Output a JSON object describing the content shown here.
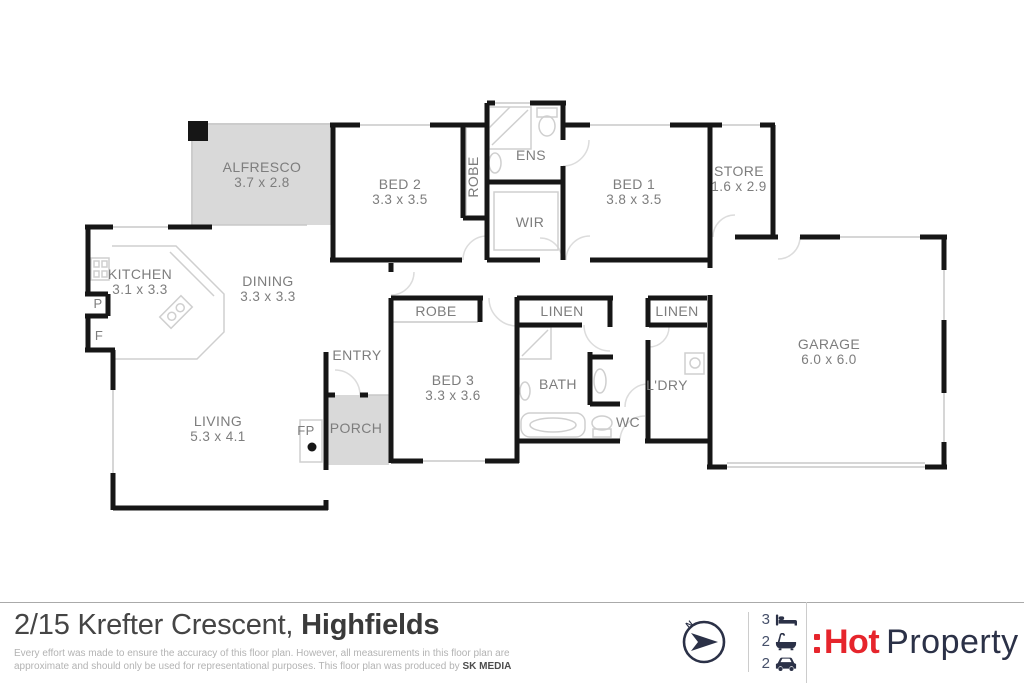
{
  "plan": {
    "rooms": {
      "alfresco": {
        "name": "ALFRESCO",
        "dims": "3.7 x 2.8"
      },
      "bed2": {
        "name": "BED 2",
        "dims": "3.3 x 3.5"
      },
      "robe2": {
        "name": "ROBE"
      },
      "ens": {
        "name": "ENS"
      },
      "wir": {
        "name": "WIR"
      },
      "bed1": {
        "name": "BED 1",
        "dims": "3.8 x 3.5"
      },
      "store": {
        "name": "STORE",
        "dims": "1.6 x 2.9"
      },
      "kitchen": {
        "name": "KITCHEN",
        "dims": "3.1 x 3.3"
      },
      "pantry": {
        "name": "P"
      },
      "fridge": {
        "name": "F"
      },
      "dining": {
        "name": "DINING",
        "dims": "3.3 x 3.3"
      },
      "entry": {
        "name": "ENTRY"
      },
      "living": {
        "name": "LIVING",
        "dims": "5.3 x 4.1"
      },
      "fireplace": {
        "name": "FP"
      },
      "porch": {
        "name": "PORCH"
      },
      "robe3": {
        "name": "ROBE"
      },
      "bed3": {
        "name": "BED 3",
        "dims": "3.3 x 3.6"
      },
      "linen1": {
        "name": "LINEN"
      },
      "bath": {
        "name": "BATH"
      },
      "wc": {
        "name": "WC"
      },
      "linen2": {
        "name": "LINEN"
      },
      "laundry": {
        "name": "L'DRY"
      },
      "garage": {
        "name": "GARAGE",
        "dims": "6.0 x 6.0"
      }
    },
    "colors": {
      "wall": "#161616",
      "area_fill": "#d9d9d9",
      "label": "#7d7d7d"
    }
  },
  "footer": {
    "address_street": "2/15 Krefter Crescent,",
    "address_suburb": "Highfields",
    "disclaimer_line1": "Every effort was made to ensure the accuracy of this floor plan. However, all measurements in this floor plan are",
    "disclaimer_line2": "approximate and should only be used for representational purposes. This floor plan was produced by",
    "producer": "SK MEDIA",
    "compass_label": "N",
    "stats": {
      "beds": "3",
      "baths": "2",
      "cars": "2"
    },
    "logo_hot": "Hot",
    "logo_property": "Property",
    "colors": {
      "accent_red": "#e6252c",
      "navy": "#2b3147"
    }
  }
}
